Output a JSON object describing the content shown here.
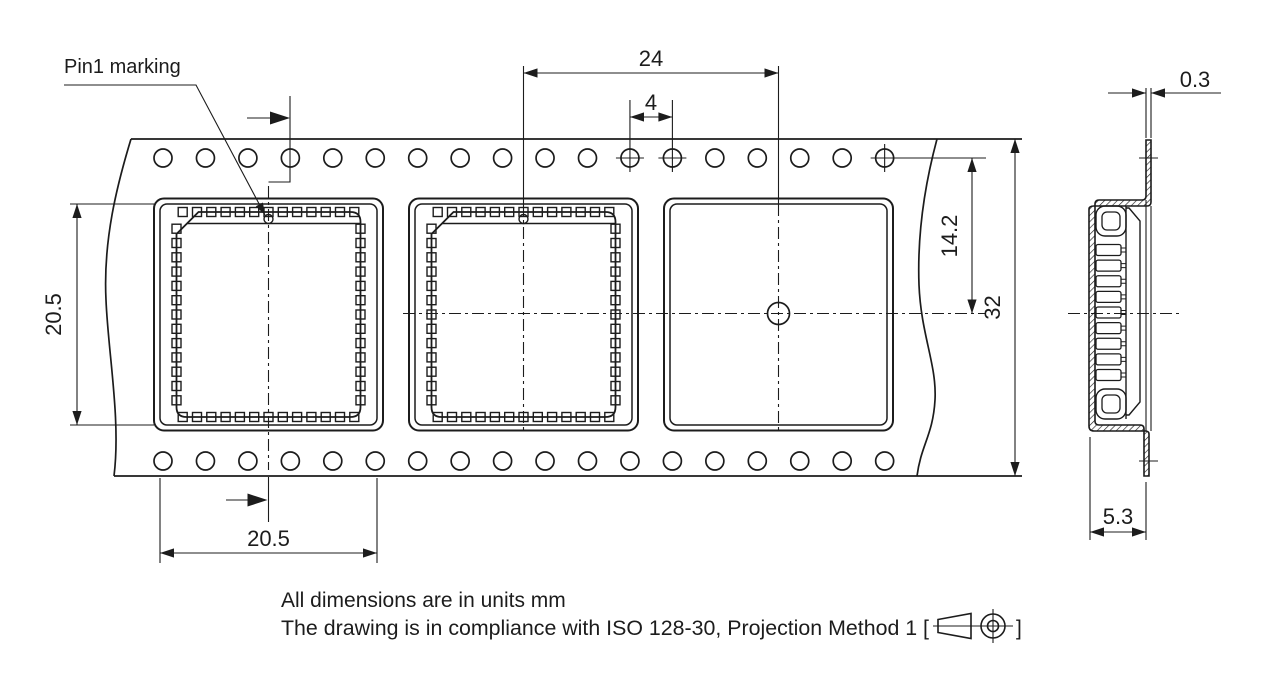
{
  "page": {
    "background": "#ffffff",
    "line_color": "#1c1c1c"
  },
  "labels": {
    "pin1_marking": "Pin1 marking"
  },
  "dimensions": {
    "pocket_pitch": "24",
    "sprocket_hole_pitch": "4",
    "pocket_length_vertical": "20.5",
    "pocket_width_horizontal": "20.5",
    "hole_center_to_pocket_center": "14.2",
    "tape_width": "32",
    "tape_thickness": "0.3",
    "pocket_depth": "5.3"
  },
  "notes": {
    "line1": "All dimensions are in units mm",
    "line2_prefix": "The drawing is in compliance with ISO 128-30, Projection Method 1 [",
    "line2_suffix": "]"
  }
}
